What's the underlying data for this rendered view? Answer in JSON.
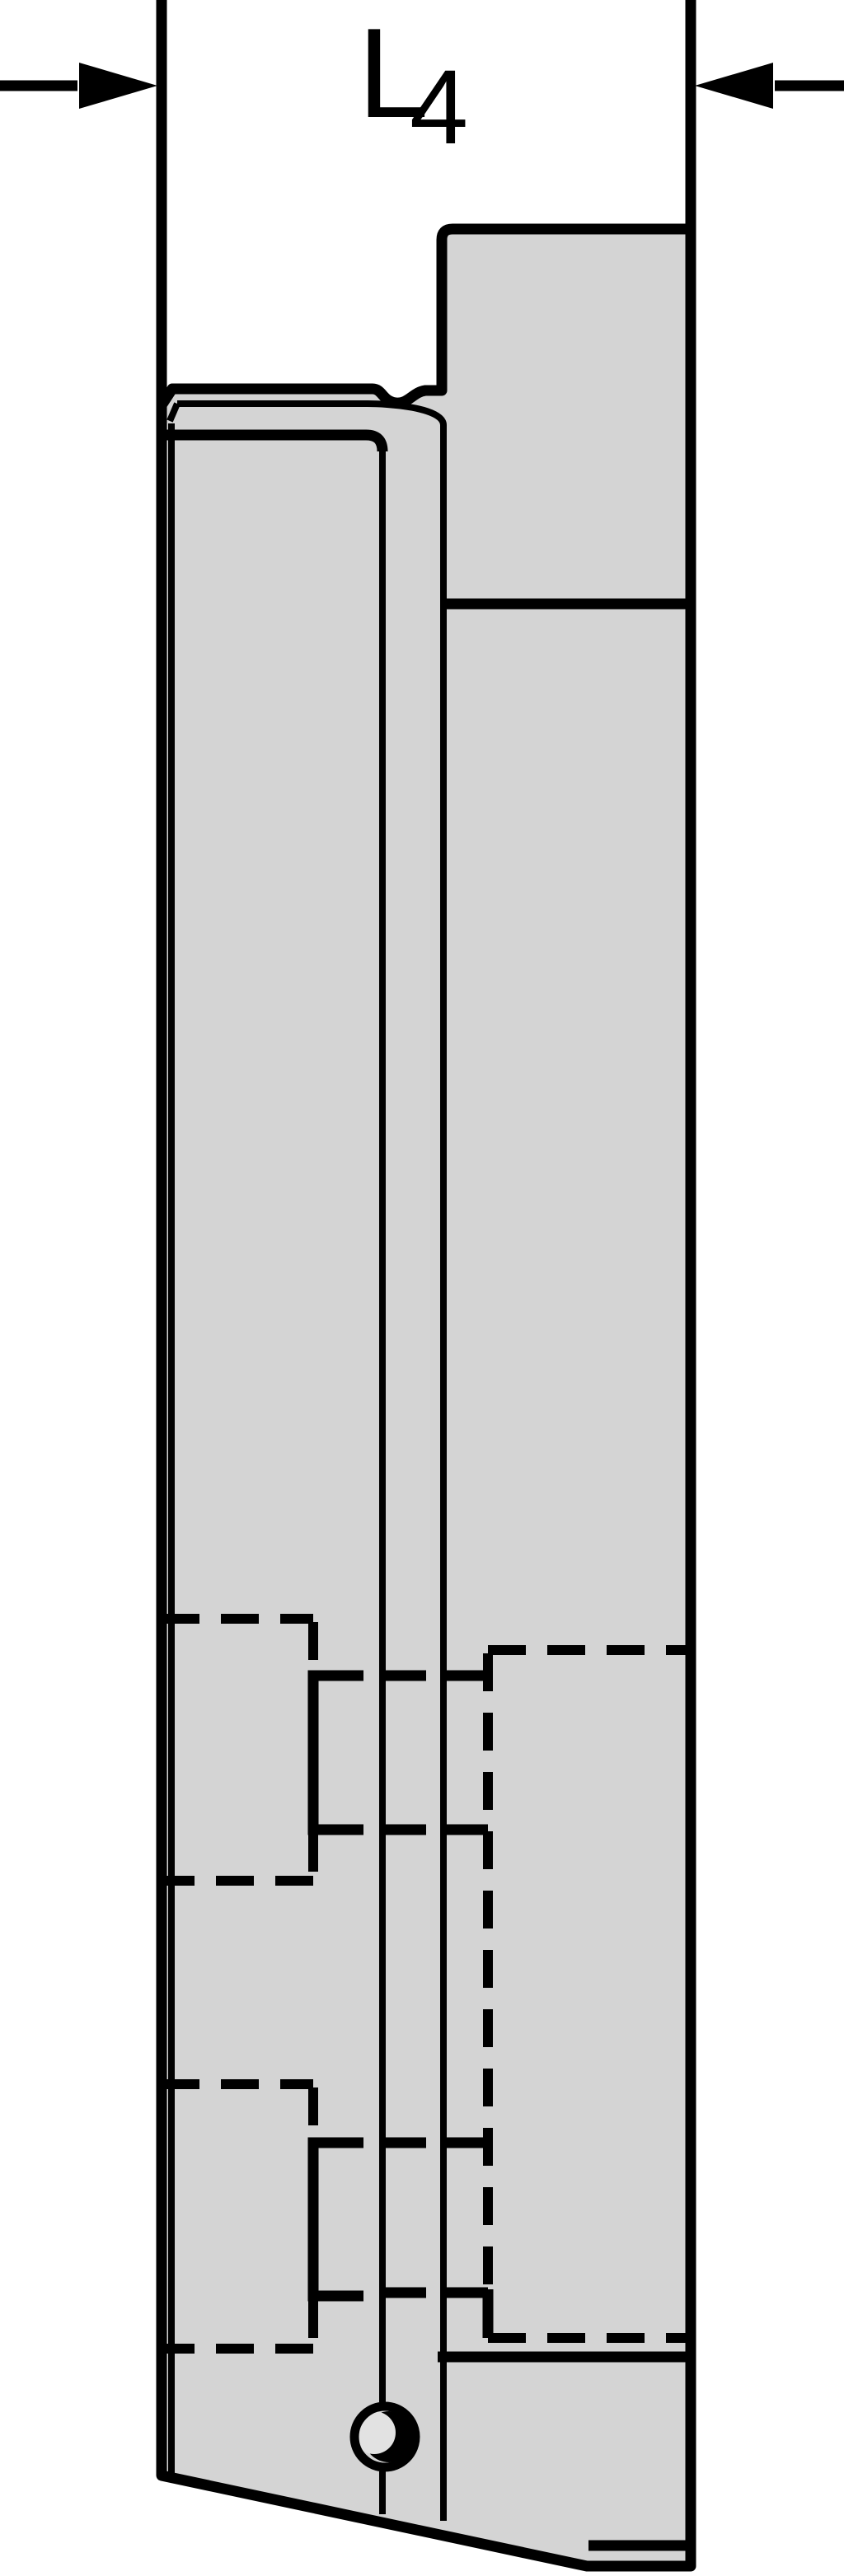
{
  "drawing": {
    "kind": "engineering-line-drawing",
    "dimension_label": {
      "main": "L",
      "subscript": "4"
    }
  },
  "colors": {
    "stroke": "#000000",
    "body-fill": "#d4d4d4",
    "hole-fill": "#e2e2e2",
    "background": "#ffffff"
  }
}
